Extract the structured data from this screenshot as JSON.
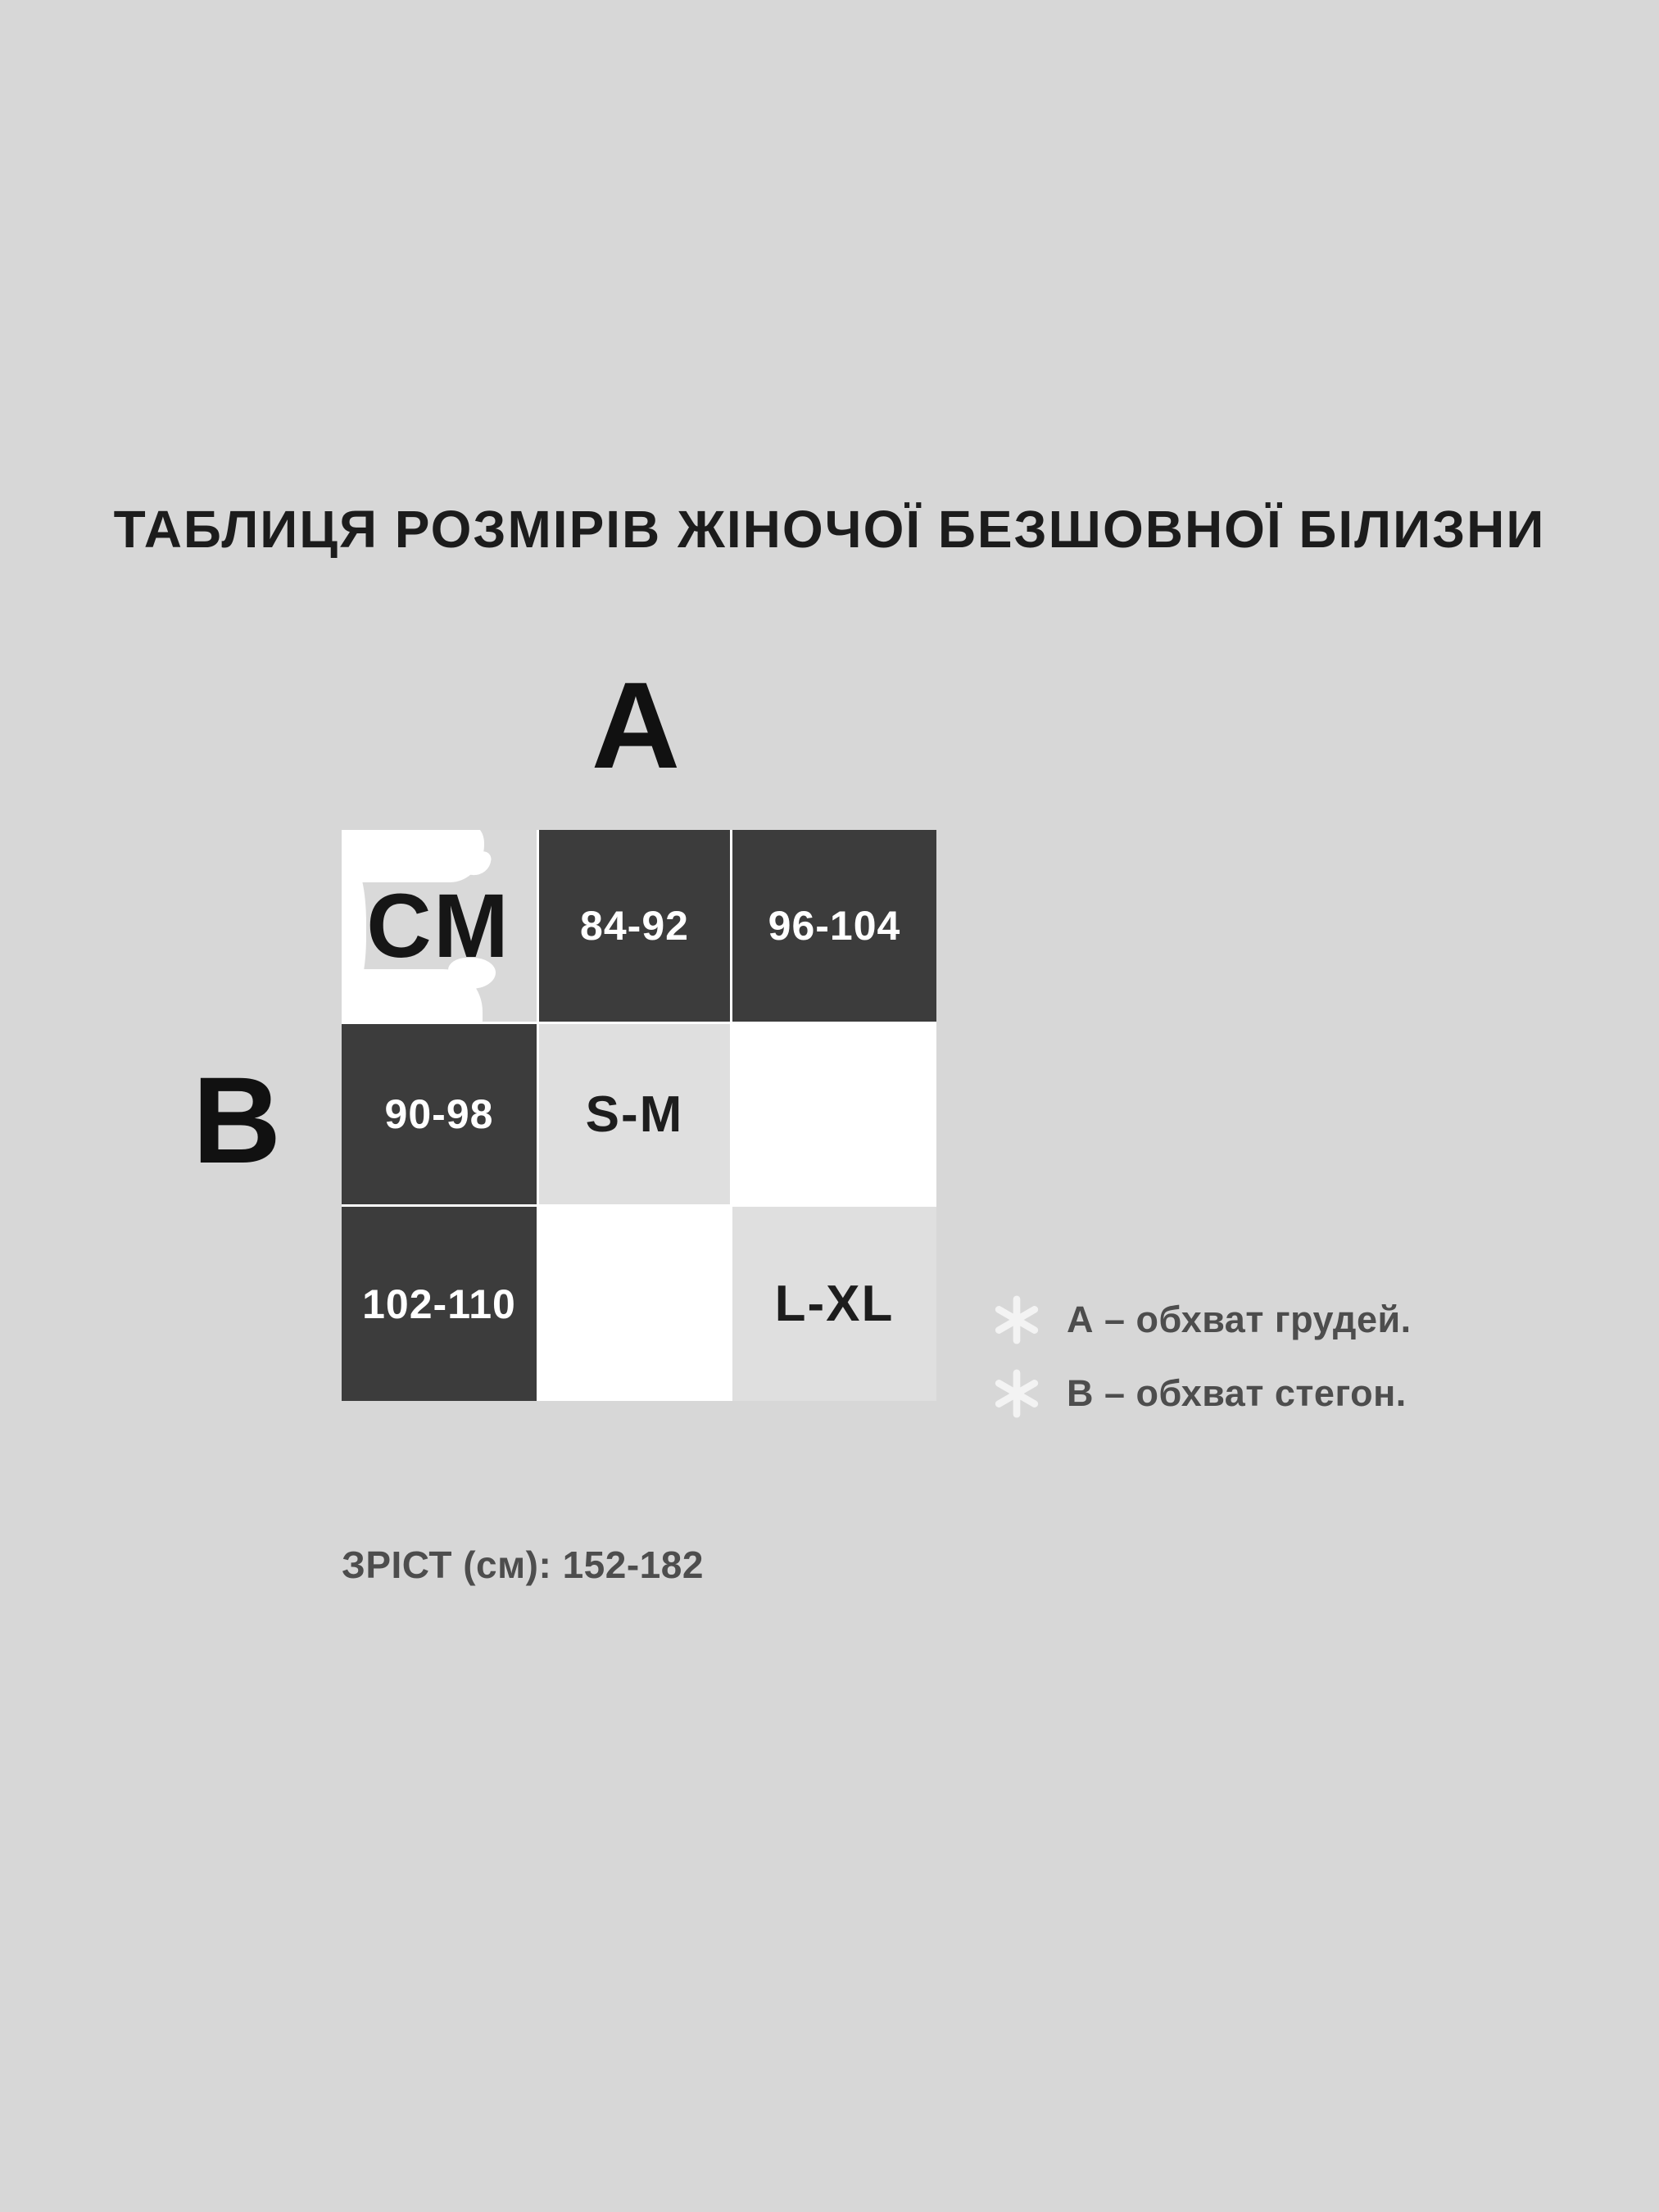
{
  "colors": {
    "page_bg": "#d7d7d7",
    "cell_dark": "#3c3c3c",
    "cell_soft": "#dfdfdf",
    "cell_unit": "#d9d9d9",
    "cell_white": "#ffffff",
    "grid_line": "#ffffff",
    "text_dark": "#1c1c1c",
    "text_on_dark": "#ffffff",
    "text_muted": "#4d4d4d",
    "icon_white": "#f3f3f3"
  },
  "title": "ТАБЛИЦЯ РОЗМІРІВ ЖІНОЧОЇ БЕЗШОВНОЇ БІЛИЗНИ",
  "measure_labels": {
    "chest_axis": "А",
    "hips_axis": "В"
  },
  "size_table": {
    "grid": [
      [
        {
          "text": "СМ"
        },
        {
          "text": "84-92"
        },
        {
          "text": "96-104"
        }
      ],
      [
        {
          "text": "90-98"
        },
        {
          "text": "S-M"
        },
        {
          "text": ""
        }
      ],
      [
        {
          "text": "102-110"
        },
        {
          "text": ""
        },
        {
          "text": "L-XL"
        }
      ]
    ]
  },
  "legend": {
    "items": [
      {
        "icon": "asterisk-icon",
        "text": "А – обхват грудей."
      },
      {
        "icon": "asterisk-icon",
        "text": "В – обхват стегон."
      }
    ]
  },
  "height_note": "ЗРІСТ (см): 152-182",
  "chart_data": {
    "type": "table",
    "title": "ТАБЛИЦЯ РОЗМІРІВ ЖІНОЧОЇ БЕЗШОВНОЇ БІЛИЗНИ",
    "unit": "СМ",
    "chest_ranges_cm": [
      "84-92",
      "96-104"
    ],
    "hip_ranges_cm": [
      "90-98",
      "102-110"
    ],
    "matrix": [
      [
        "S-M",
        ""
      ],
      [
        "",
        "L-XL"
      ]
    ],
    "notes": [
      "А – обхват грудей.",
      "В – обхват стегон.",
      "ЗРІСТ (см): 152-182"
    ]
  }
}
